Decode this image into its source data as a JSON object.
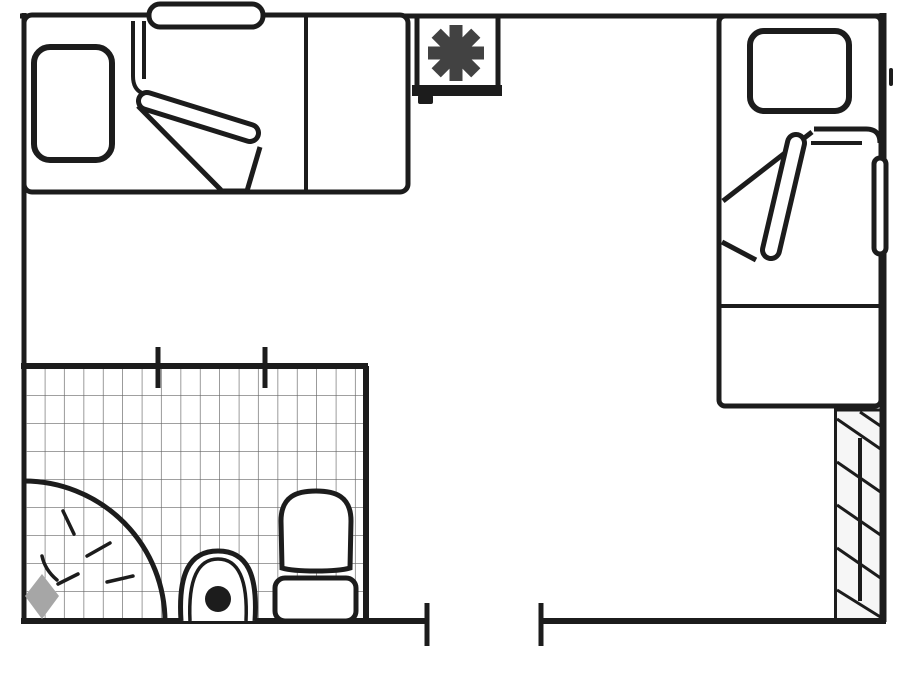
{
  "colors": {
    "line": "#1c1c1c",
    "bg": "#ffffff",
    "asterisk": "#424242",
    "showerhead": "#a6a6a6",
    "tile": "#666666",
    "strip": "#f6f6f6"
  },
  "floorplan": {
    "type": "apartment-floor-plan",
    "regions": [
      {
        "id": "bedroom-upper-left",
        "fixtures": [
          "single-bed",
          "pillow",
          "bolster-cushion",
          "folded-blanket",
          "foot-table"
        ]
      },
      {
        "id": "bedroom-right",
        "fixtures": [
          "single-bed",
          "pillow",
          "folded-blanket",
          "side-rail",
          "foot-table"
        ]
      },
      {
        "id": "bathroom",
        "fixtures": [
          "tiled-floor",
          "corner-shower",
          "shower-head",
          "spray-lines",
          "pedestal-sink",
          "toilet"
        ]
      },
      {
        "id": "stair-strip",
        "fixtures": [
          "hatched-steps"
        ]
      }
    ],
    "symbols": [
      {
        "id": "heater-unit",
        "icon": "asterisk-icon"
      }
    ],
    "openings": [
      {
        "id": "bottom-doorway",
        "jamb_ticks": 2
      },
      {
        "id": "bathroom-wall-ticks",
        "jamb_ticks": 2
      }
    ]
  }
}
